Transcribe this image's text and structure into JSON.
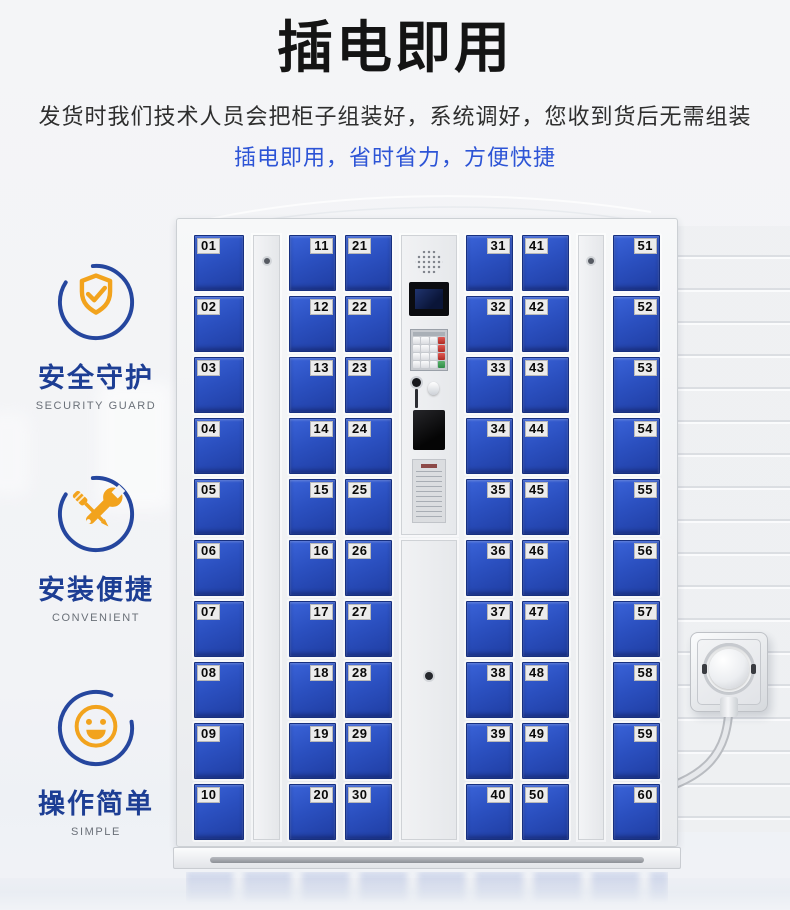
{
  "header": {
    "title": "插电即用",
    "subtitle": "发货时我们技术人员会把柜子组装好，系统调好，您收到货后无需组装",
    "highlight": "插电即用，省时省力，方便快捷"
  },
  "features": [
    {
      "zh": "安全守护",
      "en": "SECURITY GUARD",
      "icon": "shield-check-icon"
    },
    {
      "zh": "安装便捷",
      "en": "CONVENIENT",
      "icon": "crossed-tools-icon"
    },
    {
      "zh": "操作简单",
      "en": "SIMPLE",
      "icon": "smiley-face-icon"
    }
  ],
  "locker": {
    "columns": [
      {
        "type": "doors",
        "label_side": "left",
        "numbers": [
          "01",
          "02",
          "03",
          "04",
          "05",
          "06",
          "07",
          "08",
          "09",
          "10"
        ]
      },
      {
        "type": "divider"
      },
      {
        "type": "doors",
        "label_side": "right",
        "numbers": [
          "11",
          "12",
          "13",
          "14",
          "15",
          "16",
          "17",
          "18",
          "19",
          "20"
        ]
      },
      {
        "type": "doors",
        "label_side": "left",
        "numbers": [
          "21",
          "22",
          "23",
          "24",
          "25",
          "26",
          "27",
          "28",
          "29",
          "30"
        ]
      },
      {
        "type": "panel"
      },
      {
        "type": "doors",
        "label_side": "right",
        "numbers": [
          "31",
          "32",
          "33",
          "34",
          "35",
          "36",
          "37",
          "38",
          "39",
          "40"
        ]
      },
      {
        "type": "doors",
        "label_side": "left",
        "numbers": [
          "41",
          "42",
          "43",
          "44",
          "45",
          "46",
          "47",
          "48",
          "49",
          "50"
        ]
      },
      {
        "type": "divider"
      },
      {
        "type": "doors",
        "label_side": "right",
        "numbers": [
          "51",
          "52",
          "53",
          "54",
          "55",
          "56",
          "57",
          "58",
          "59",
          "60"
        ]
      }
    ]
  },
  "colors": {
    "door_blue": "#2b50c0",
    "accent_orange": "#f2a31d",
    "icon_circle_blue": "#25469e",
    "feature_text_blue": "#1d3e94",
    "highlight_blue": "#2d54d6"
  }
}
